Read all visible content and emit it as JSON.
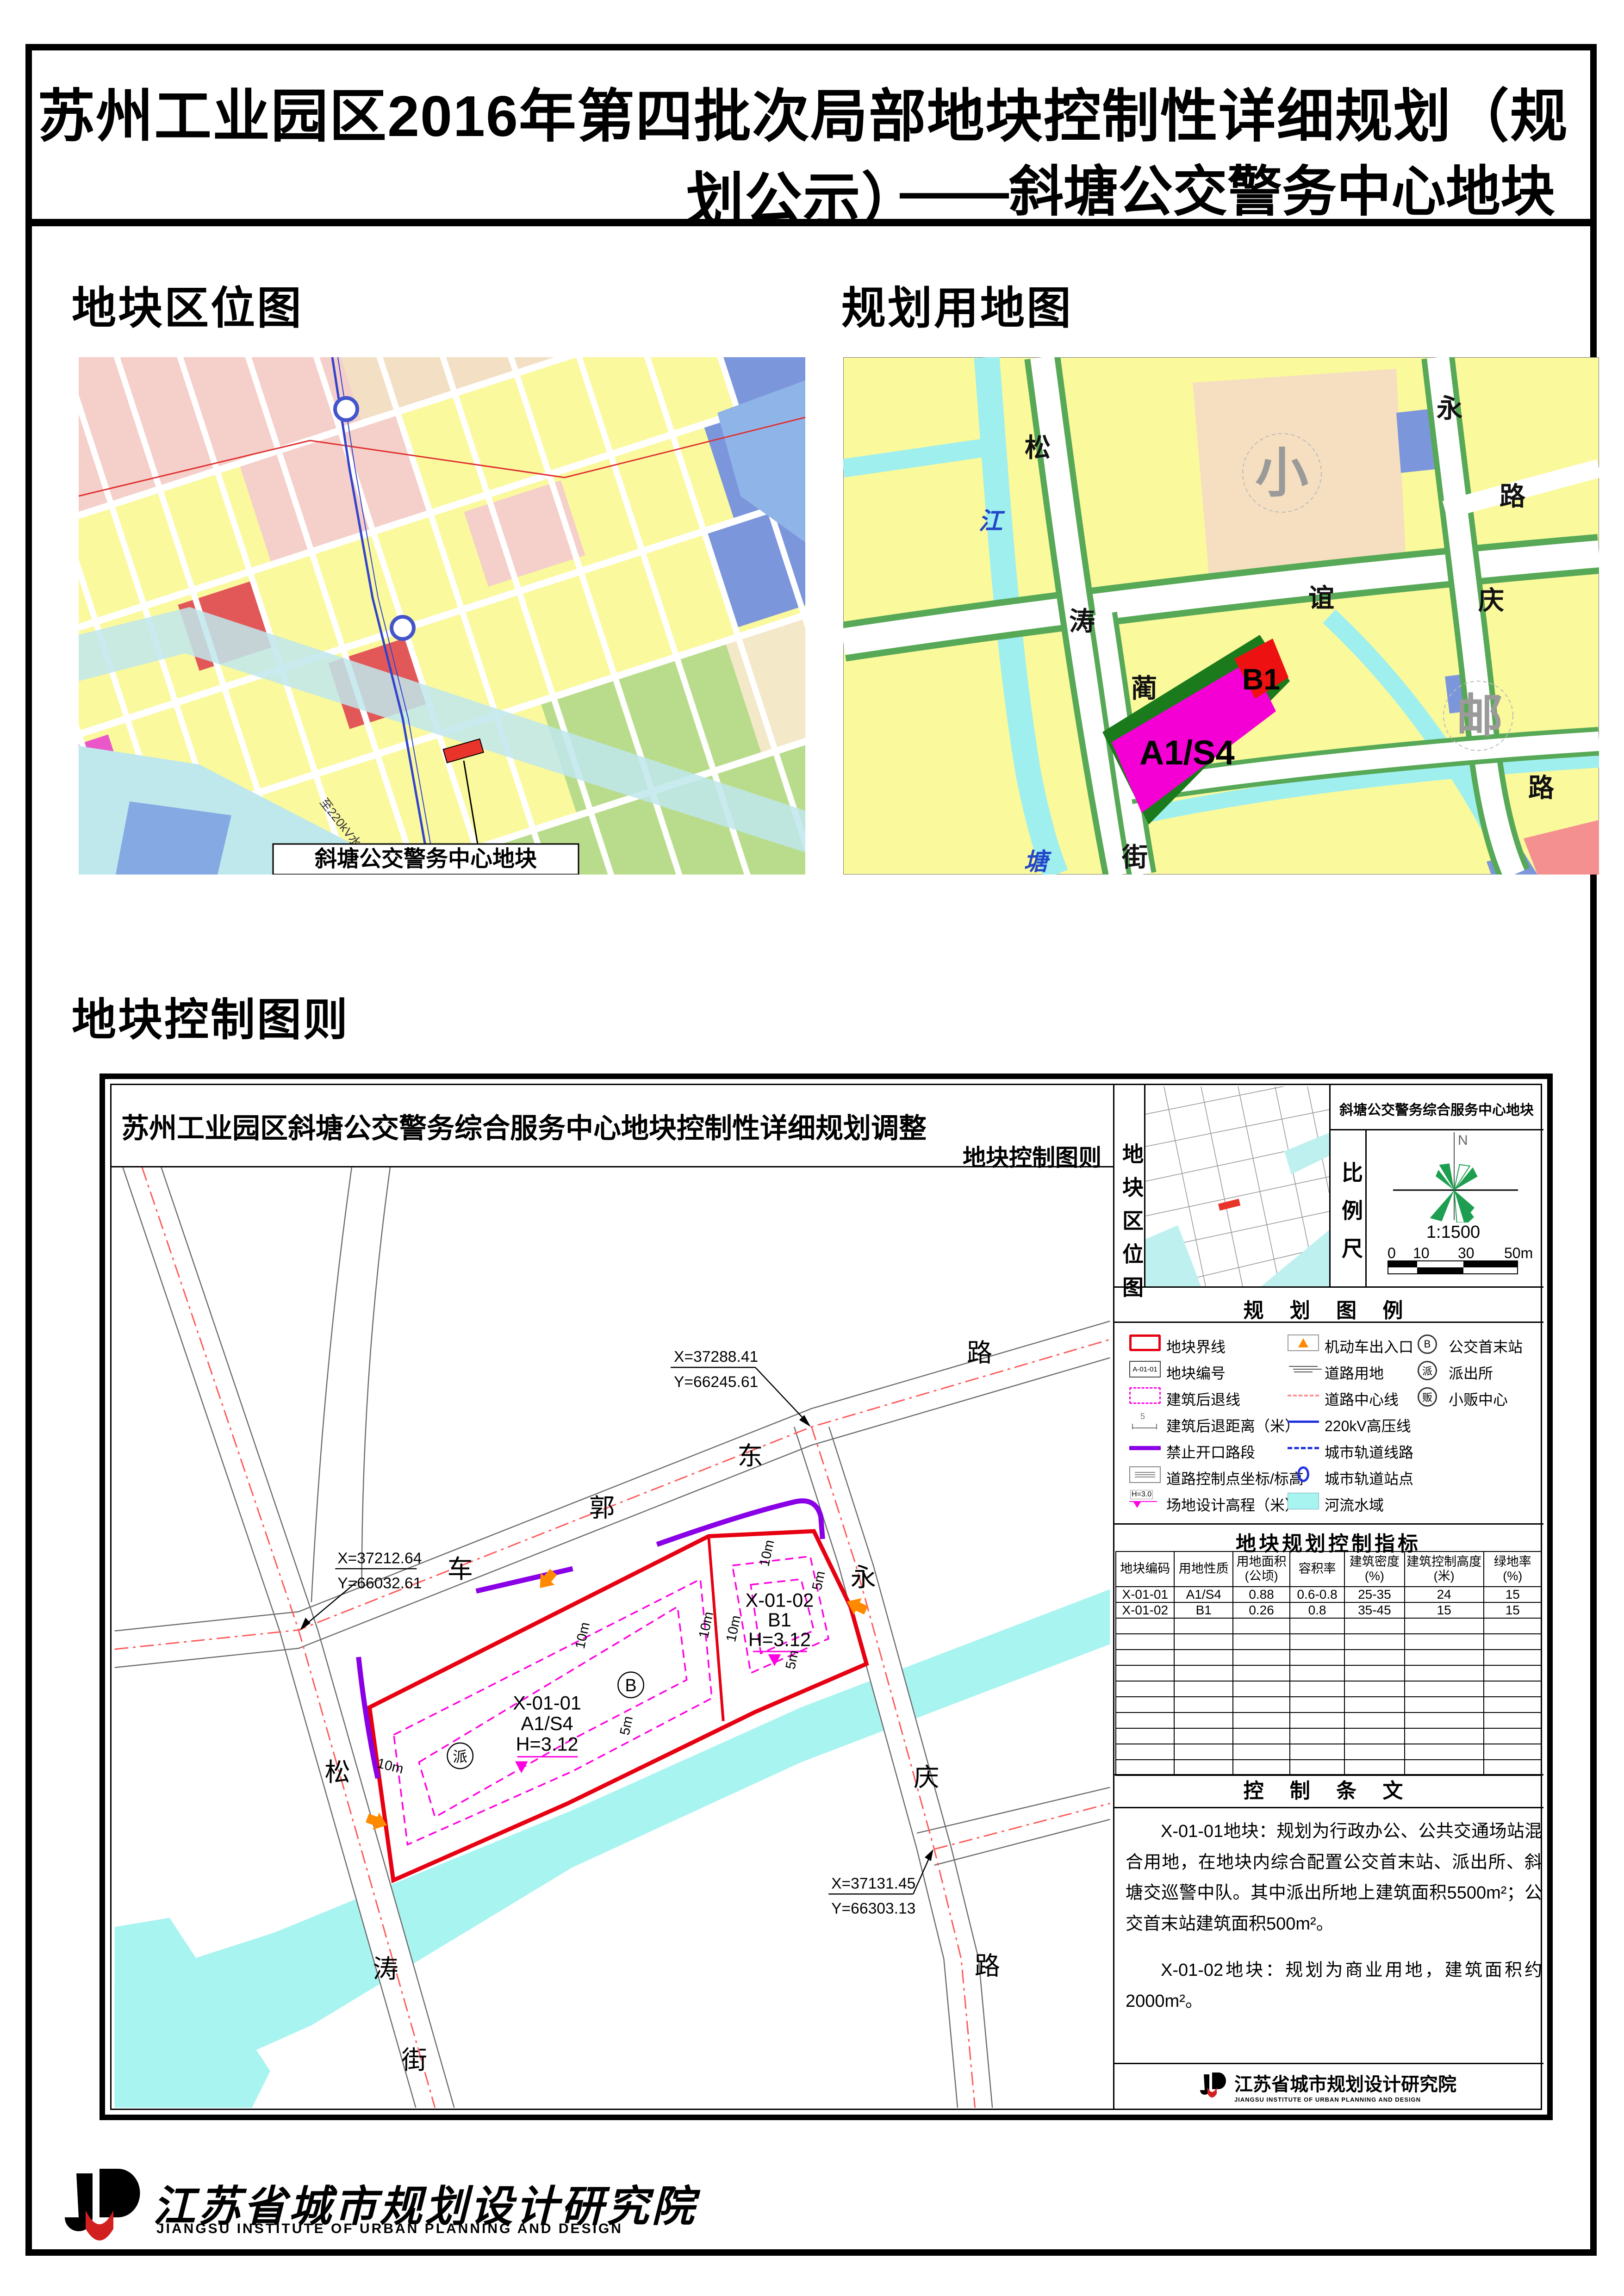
{
  "page": {
    "title_line1": "苏州工业园区2016年第四批次局部地块控制性详细规划（规划公示）",
    "title_line2": "——斜塘公交警务中心地块"
  },
  "sections": {
    "location_map": "地块区位图",
    "landuse_map": "规划用地图",
    "control_plan": "地块控制图则"
  },
  "location_map": {
    "callout": "斜塘公交警务中心地块",
    "power_note": "至220kV水乡变"
  },
  "landuse_map": {
    "parcel_a1s4": "A1/S4",
    "parcel_b1": "B1",
    "labels": {
      "song": "松",
      "jiang": "江",
      "tao": "涛",
      "tang": "塘",
      "lin": "蔺",
      "jie": "街",
      "yi": "谊",
      "yong": "永",
      "lu_ne": "路",
      "qing": "庆",
      "you": "邮",
      "xiao": "小",
      "lu_se": "路"
    }
  },
  "plan": {
    "title": "苏州工业园区斜塘公交警务综合服务中心地块控制性详细规划调整",
    "subtitle": "地块控制图则",
    "coords": {
      "c1x": "X=37288.41",
      "c1y": "Y=66245.61",
      "c2x": "X=37212.64",
      "c2y": "Y=66032.61",
      "c3x": "X=37131.45",
      "c3y": "Y=66303.13"
    },
    "roads": {
      "che": "车",
      "guo": "郭",
      "dong": "东",
      "lu_ne": "路",
      "yong": "永",
      "qing": "庆",
      "lu_se": "路",
      "song": "松",
      "tao": "涛",
      "jie": "街"
    },
    "parcel1": {
      "code": "X-01-01",
      "use": "A1/S4",
      "h": "H=3.12",
      "bus": "B",
      "pai": "派"
    },
    "parcel2": {
      "code": "X-01-02",
      "use": "B1",
      "h": "H=3.12"
    },
    "dims": {
      "d10": "10m",
      "d5": "5m"
    }
  },
  "panel": {
    "loc_label": "地块区位图",
    "title": "斜塘公交警务综合服务中心地块",
    "scale_label": "比例尺",
    "north": "N",
    "scale": "1:1500",
    "ticks": [
      "0",
      "10",
      "30",
      "50m"
    ]
  },
  "legend": {
    "title": "规 划 图 例",
    "icon_texts": {
      "code": "A-01-01",
      "dist": "5",
      "elev": "H=3.0",
      "bus": "B",
      "police": "派",
      "hawker": "贩"
    },
    "cols": [
      [
        {
          "icon": "boundary",
          "label": "地块界线"
        },
        {
          "icon": "code",
          "label": "地块编号"
        },
        {
          "icon": "setback",
          "label": "建筑后退线"
        },
        {
          "icon": "dist",
          "label": "建筑后退距离（米）"
        },
        {
          "icon": "noopen",
          "label": "禁止开口路段"
        },
        {
          "icon": "ctrlpt",
          "label": "道路控制点坐标/标高"
        },
        {
          "icon": "elev",
          "label": "场地设计高程（米）"
        }
      ],
      [
        {
          "icon": "entrance",
          "label": "机动车出入口"
        },
        {
          "icon": "roadland",
          "label": "道路用地"
        },
        {
          "icon": "roadcenter",
          "label": "道路中心线"
        },
        {
          "icon": "hvline",
          "label": "220kV高压线"
        },
        {
          "icon": "metroline",
          "label": "城市轨道线路"
        },
        {
          "icon": "metrostation",
          "label": "城市轨道站点"
        },
        {
          "icon": "river",
          "label": "河流水域"
        }
      ],
      [
        {
          "icon": "busstop",
          "label": "公交首末站"
        },
        {
          "icon": "police",
          "label": "派出所"
        },
        {
          "icon": "hawker",
          "label": "小贩中心"
        }
      ]
    ]
  },
  "table": {
    "title": "地块规划控制指标",
    "headers": [
      "地块编码",
      "用地性质",
      "用地面积\n(公顷)",
      "容积率",
      "建筑密度\n(%)",
      "建筑控制高度\n(米)",
      "绿地率\n(%)"
    ],
    "rows": [
      [
        "X-01-01",
        "A1/S4",
        "0.88",
        "0.6-0.8",
        "25-35",
        "24",
        "15"
      ],
      [
        "X-01-02",
        "B1",
        "0.26",
        "0.8",
        "35-45",
        "15",
        "15"
      ]
    ],
    "empty_rows": 10
  },
  "provisions": {
    "title": "控 制 条 文",
    "p1": "X-01-01地块：规划为行政办公、公共交通场站混合用地，在地块内综合配置公交首末站、派出所、斜塘交巡警中队。其中派出所地上建筑面积5500m²；公交首末站建筑面积500m²。",
    "p2": "X-01-02地块：规划为商业用地，建筑面积约2000m²。"
  },
  "institute": {
    "cn": "江苏省城市规划设计研究院",
    "en": "JIANGSU INSTITUTE OF URBAN PLANNING AND DESIGN"
  }
}
